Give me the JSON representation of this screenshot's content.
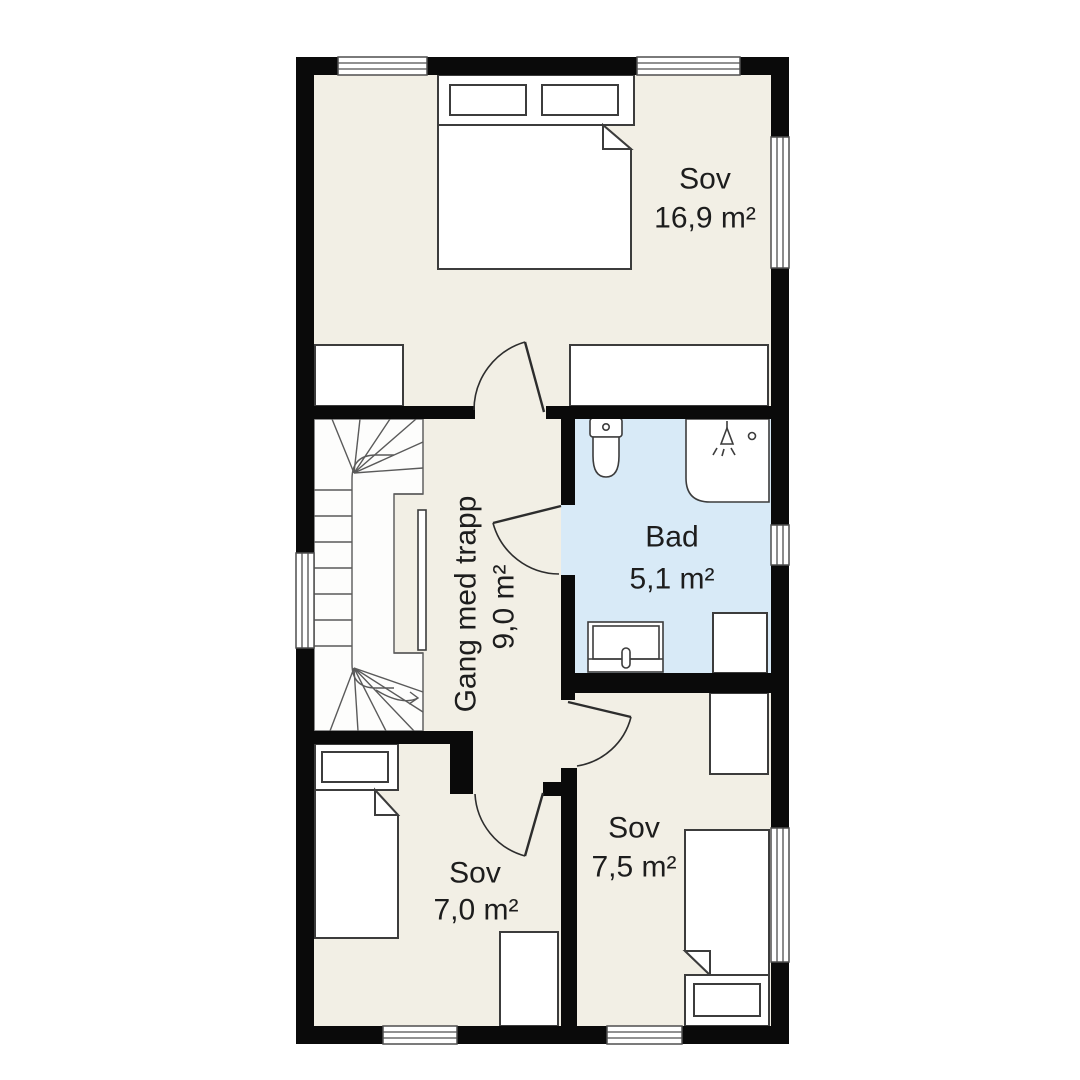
{
  "plan": {
    "kind": "floor-plan",
    "rooms": [
      {
        "name": "Sov",
        "area": "16,9 m²"
      },
      {
        "name": "Bad",
        "area": "5,1 m²"
      },
      {
        "name": "Gang med trapp",
        "area": "9,0 m²"
      },
      {
        "name": "Sov",
        "area": "7,0 m²"
      },
      {
        "name": "Sov",
        "area": "7,5 m²"
      }
    ]
  },
  "colors": {
    "bg": "#ffffff",
    "floor": "#f2efe5",
    "bath": "#d8eaf7",
    "wall": "#0a0a0a",
    "stroke": "#3c3c3c",
    "stair": "#5a5a5a",
    "text": "#1d1d1d"
  }
}
